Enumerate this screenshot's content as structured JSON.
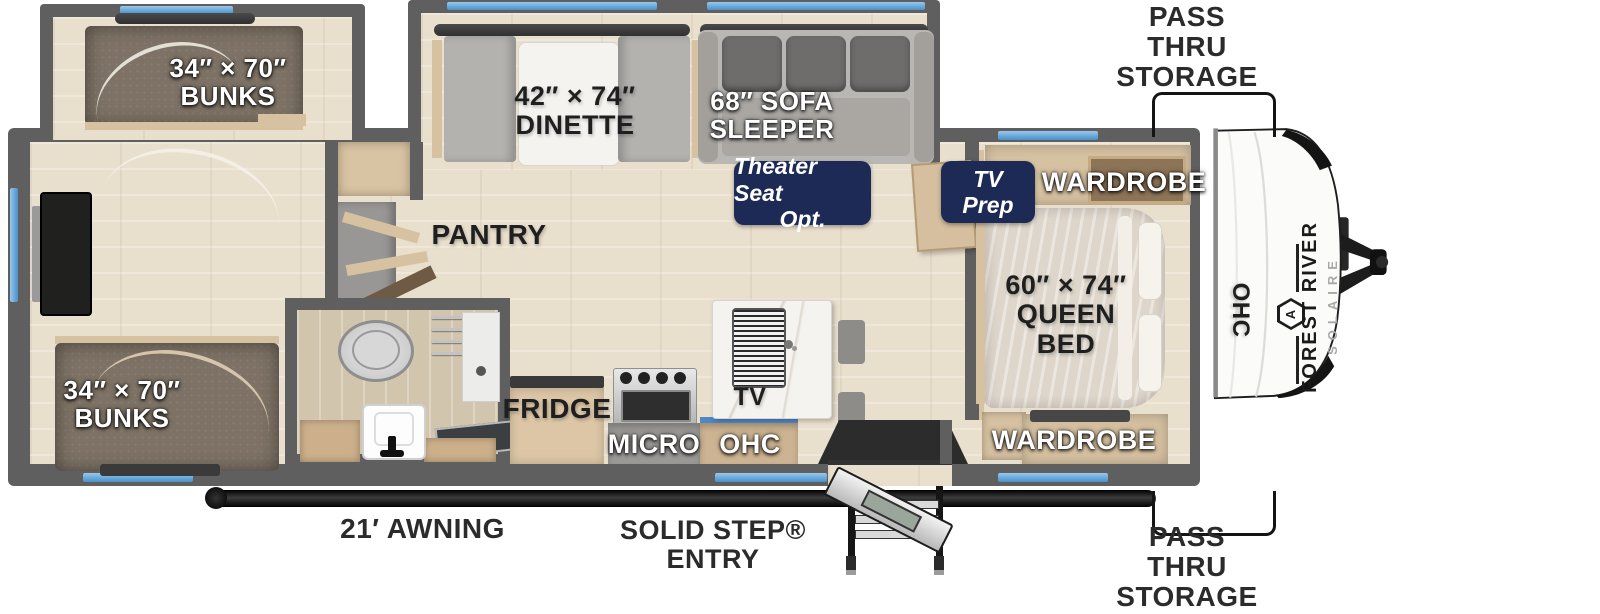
{
  "colors": {
    "wall_gray": "#5f5f5f",
    "floor_beige": "#e9dfcd",
    "accent_navy": "#1c2a55",
    "window_blue": "#64a7da",
    "cabinet_wood": "#d6c1a1",
    "mattress_brown": "#7d7265",
    "awning_black": "#0d0d0d",
    "front_cap_white": "#fbfbfa"
  },
  "labels": {
    "bunks_top": {
      "line1": "34″ × 70″",
      "line2": "BUNKS"
    },
    "bunks_bottom": {
      "line1": "34″ × 70″",
      "line2": "BUNKS"
    },
    "dinette": {
      "line1": "42″ × 74″",
      "line2": "DINETTE"
    },
    "sofa": {
      "line1": "68″ SOFA",
      "line2": "SLEEPER"
    },
    "theater_badge": {
      "line1": "Theater Seat",
      "line2": "Opt."
    },
    "tv_prep_badge": {
      "line1": "TV",
      "line2": "Prep"
    },
    "wardrobe_top": "WARDROBE",
    "wardrobe_bottom": "WARDROBE",
    "queen_bed": {
      "line1": "60″ × 74″",
      "line2": "QUEEN",
      "line3": "BED"
    },
    "ohc_bedroom": "OHC",
    "pantry": "PANTRY",
    "fridge": "FRIDGE",
    "micro": "MICRO",
    "ohc_kitchen": "OHC",
    "tv_island": "TV",
    "pass_thru_top": {
      "line1": "PASS THRU",
      "line2": "STORAGE"
    },
    "pass_thru_bottom": {
      "line1": "PASS THRU",
      "line2": "STORAGE"
    },
    "solid_step": {
      "line1": "SOLID STEP®",
      "line2": "ENTRY"
    },
    "awning": "21′ AWNING",
    "brand": {
      "name": "FOREST RIVER",
      "model": "SOLAIRE",
      "monogram": "A"
    }
  }
}
